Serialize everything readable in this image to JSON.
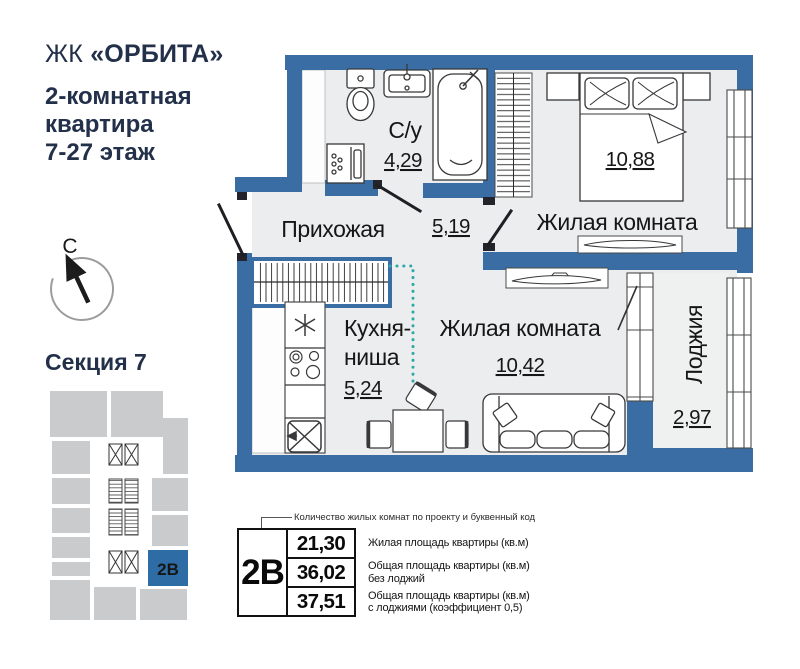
{
  "header": {
    "brand_prefix": "ЖК",
    "brand_name": "«ОРБИТА»",
    "subtitle_line1": "2-комнатная",
    "subtitle_line2": "квартира",
    "subtitle_line3": "7-27 этаж"
  },
  "compass": {
    "north_label": "С"
  },
  "section": {
    "title": "Секция 7",
    "unit_code": "2В"
  },
  "plan": {
    "rooms": [
      {
        "name": "С/у",
        "area": "4,29"
      },
      {
        "name": "Прихожая",
        "area": "5,19"
      },
      {
        "name": "Жилая комната",
        "area": "10,88"
      },
      {
        "name_line1": "Кухня-",
        "name_line2": "ниша",
        "area": "5,24"
      },
      {
        "name": "Жилая комната",
        "area": "10,42"
      },
      {
        "name": "Лоджия",
        "area": "2,97"
      }
    ]
  },
  "legend": {
    "callout": "Количество жилых комнат по проекту и буквенный код",
    "code": "2В",
    "rows": [
      {
        "value": "21,30",
        "line1": "Жилая площадь квартиры (кв.м)",
        "line2": ""
      },
      {
        "value": "36,02",
        "line1": "Общая площадь квартиры (кв.м)",
        "line2": "без лоджий"
      },
      {
        "value": "37,51",
        "line1": "Общая площадь квартиры (кв.м)",
        "line2": "с лоджиями (коэффициент 0,5)"
      }
    ]
  },
  "colors": {
    "wall_blue": "#3A6DA3",
    "unit_highlight_blue": "#2E6CA6",
    "accent_teal": "#2EA9A5",
    "heading_navy": "#22304A",
    "block_gray": "#C9CBCD",
    "floor_gray": "#ECEDEF"
  },
  "icons": {
    "north-arrow-icon": "solid arrow pointing up-left inside open circle",
    "elevator-icon": "rectangle with X cross",
    "stairs-icon": "rectangle with dense horizontal treads",
    "wardrobe-icon": "hatched strip (clothes rail)",
    "door-swing": "diagonal door leaf line"
  }
}
